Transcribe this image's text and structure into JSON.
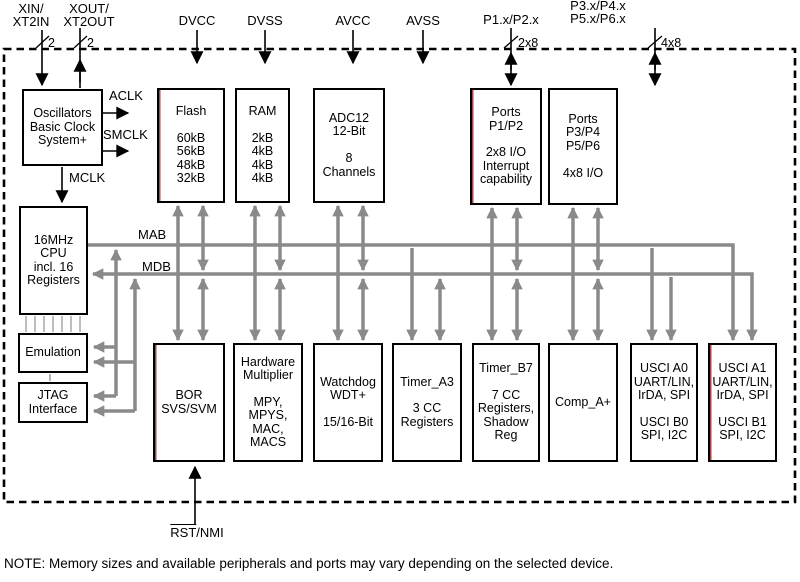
{
  "top_pins": {
    "xin": {
      "lines": [
        "XIN/",
        "XT2IN"
      ]
    },
    "xout": {
      "lines": [
        "XOUT/",
        "XT2OUT"
      ]
    },
    "dvcc": "DVCC",
    "dvss": "DVSS",
    "avcc": "AVCC",
    "avss": "AVSS",
    "p1p2": "P1.x/P2.x",
    "p3p6": {
      "lines": [
        "P3.x/P4.x",
        "P5.x/P6.x"
      ]
    }
  },
  "bus_widths": {
    "xin": "2",
    "xout": "2",
    "p1p2": "2x8",
    "p3p6": "4x8"
  },
  "clocks": {
    "aclk": "ACLK",
    "smclk": "SMCLK",
    "mclk": "MCLK"
  },
  "buses": {
    "mab": "MAB",
    "mdb": "MDB"
  },
  "blocks": {
    "oscillators": {
      "lines": [
        "Oscillators",
        "Basic Clock",
        "System+"
      ]
    },
    "flash": {
      "lines": [
        "Flash",
        "",
        "60kB",
        "56kB",
        "48kB",
        "32kB"
      ]
    },
    "ram": {
      "lines": [
        "RAM",
        "",
        "2kB",
        "4kB",
        "4kB",
        "4kB"
      ]
    },
    "adc12": {
      "lines": [
        "ADC12",
        "12-Bit",
        "",
        "8",
        "Channels"
      ]
    },
    "ports_p1_p2": {
      "lines": [
        "Ports",
        "P1/P2",
        "",
        "2x8 I/O",
        "Interrupt",
        "capability"
      ]
    },
    "ports_p3_p6": {
      "lines": [
        "Ports",
        "P3/P4",
        "P5/P6",
        "",
        "4x8 I/O"
      ]
    },
    "cpu": {
      "lines": [
        "16MHz",
        "CPU",
        "incl. 16",
        "Registers"
      ]
    },
    "emulation": {
      "lines": [
        "Emulation"
      ]
    },
    "jtag": {
      "lines": [
        "JTAG",
        "Interface"
      ]
    },
    "bor": {
      "lines": [
        "BOR",
        "SVS/SVM"
      ]
    },
    "multiplier": {
      "lines": [
        "Hardware",
        "Multiplier",
        "",
        "MPY,",
        "MPYS,",
        "MAC,",
        "MACS"
      ]
    },
    "watchdog": {
      "lines": [
        "Watchdog",
        "WDT+",
        "",
        "15/16-Bit"
      ]
    },
    "timer_a3": {
      "lines": [
        "Timer_A3",
        "",
        "3 CC",
        "Registers"
      ]
    },
    "timer_b7": {
      "lines": [
        "Timer_B7",
        "",
        "7 CC",
        "Registers,",
        "Shadow",
        "Reg"
      ]
    },
    "comp_a": {
      "lines": [
        "Comp_A+"
      ]
    },
    "usci_0": {
      "lines": [
        "USCI A0",
        "UART/LIN,",
        "IrDA, SPI",
        "",
        "USCI B0",
        "SPI, I2C"
      ]
    },
    "usci_1": {
      "lines": [
        "USCI A1",
        "UART/LIN,",
        "IrDA, SPI",
        "",
        "USCI B1",
        "SPI, I2C"
      ]
    }
  },
  "reset_pin": {
    "overline_part": "RST",
    "plain_part": "/NMI"
  },
  "note": "NOTE: Memory sizes and available peripherals and ports may vary depending on the selected device.",
  "colors": {
    "bus_gray": "#8a8a8a",
    "line_black": "#000000",
    "block_accent_red": "#8b1a1a",
    "background": "#ffffff"
  }
}
